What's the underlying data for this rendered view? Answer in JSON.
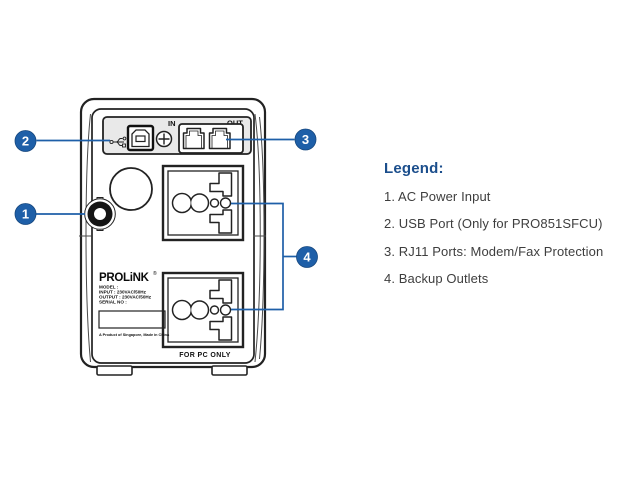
{
  "device": {
    "brand": "PROLiNK",
    "brand_mark": "®",
    "port_panel": {
      "in_label": "IN",
      "out_label": "OUT"
    },
    "spec_label": {
      "lines": [
        "MODEL :",
        "INPUT : 230VAC/50Hz",
        "OUTPUT : 230VAC/50Hz",
        "SERIAL NO :"
      ],
      "origin_note": "A Product of Singapore, Made in China"
    },
    "outlet_note": "FOR PC ONLY"
  },
  "callouts": [
    "1",
    "2",
    "3",
    "4"
  ],
  "legend": {
    "heading": "Legend:",
    "items": [
      "1. AC Power Input",
      "2. USB Port (Only for PRO851SFCU)",
      "3. RJ11 Ports: Modem/Fax Protection",
      "4. Backup Outlets"
    ]
  },
  "colors": {
    "callout_blue": "#1e5fa8",
    "legend_heading_blue": "#1b4e8c",
    "outline_dark": "#222222",
    "panel_gray": "#e9e9e9"
  }
}
